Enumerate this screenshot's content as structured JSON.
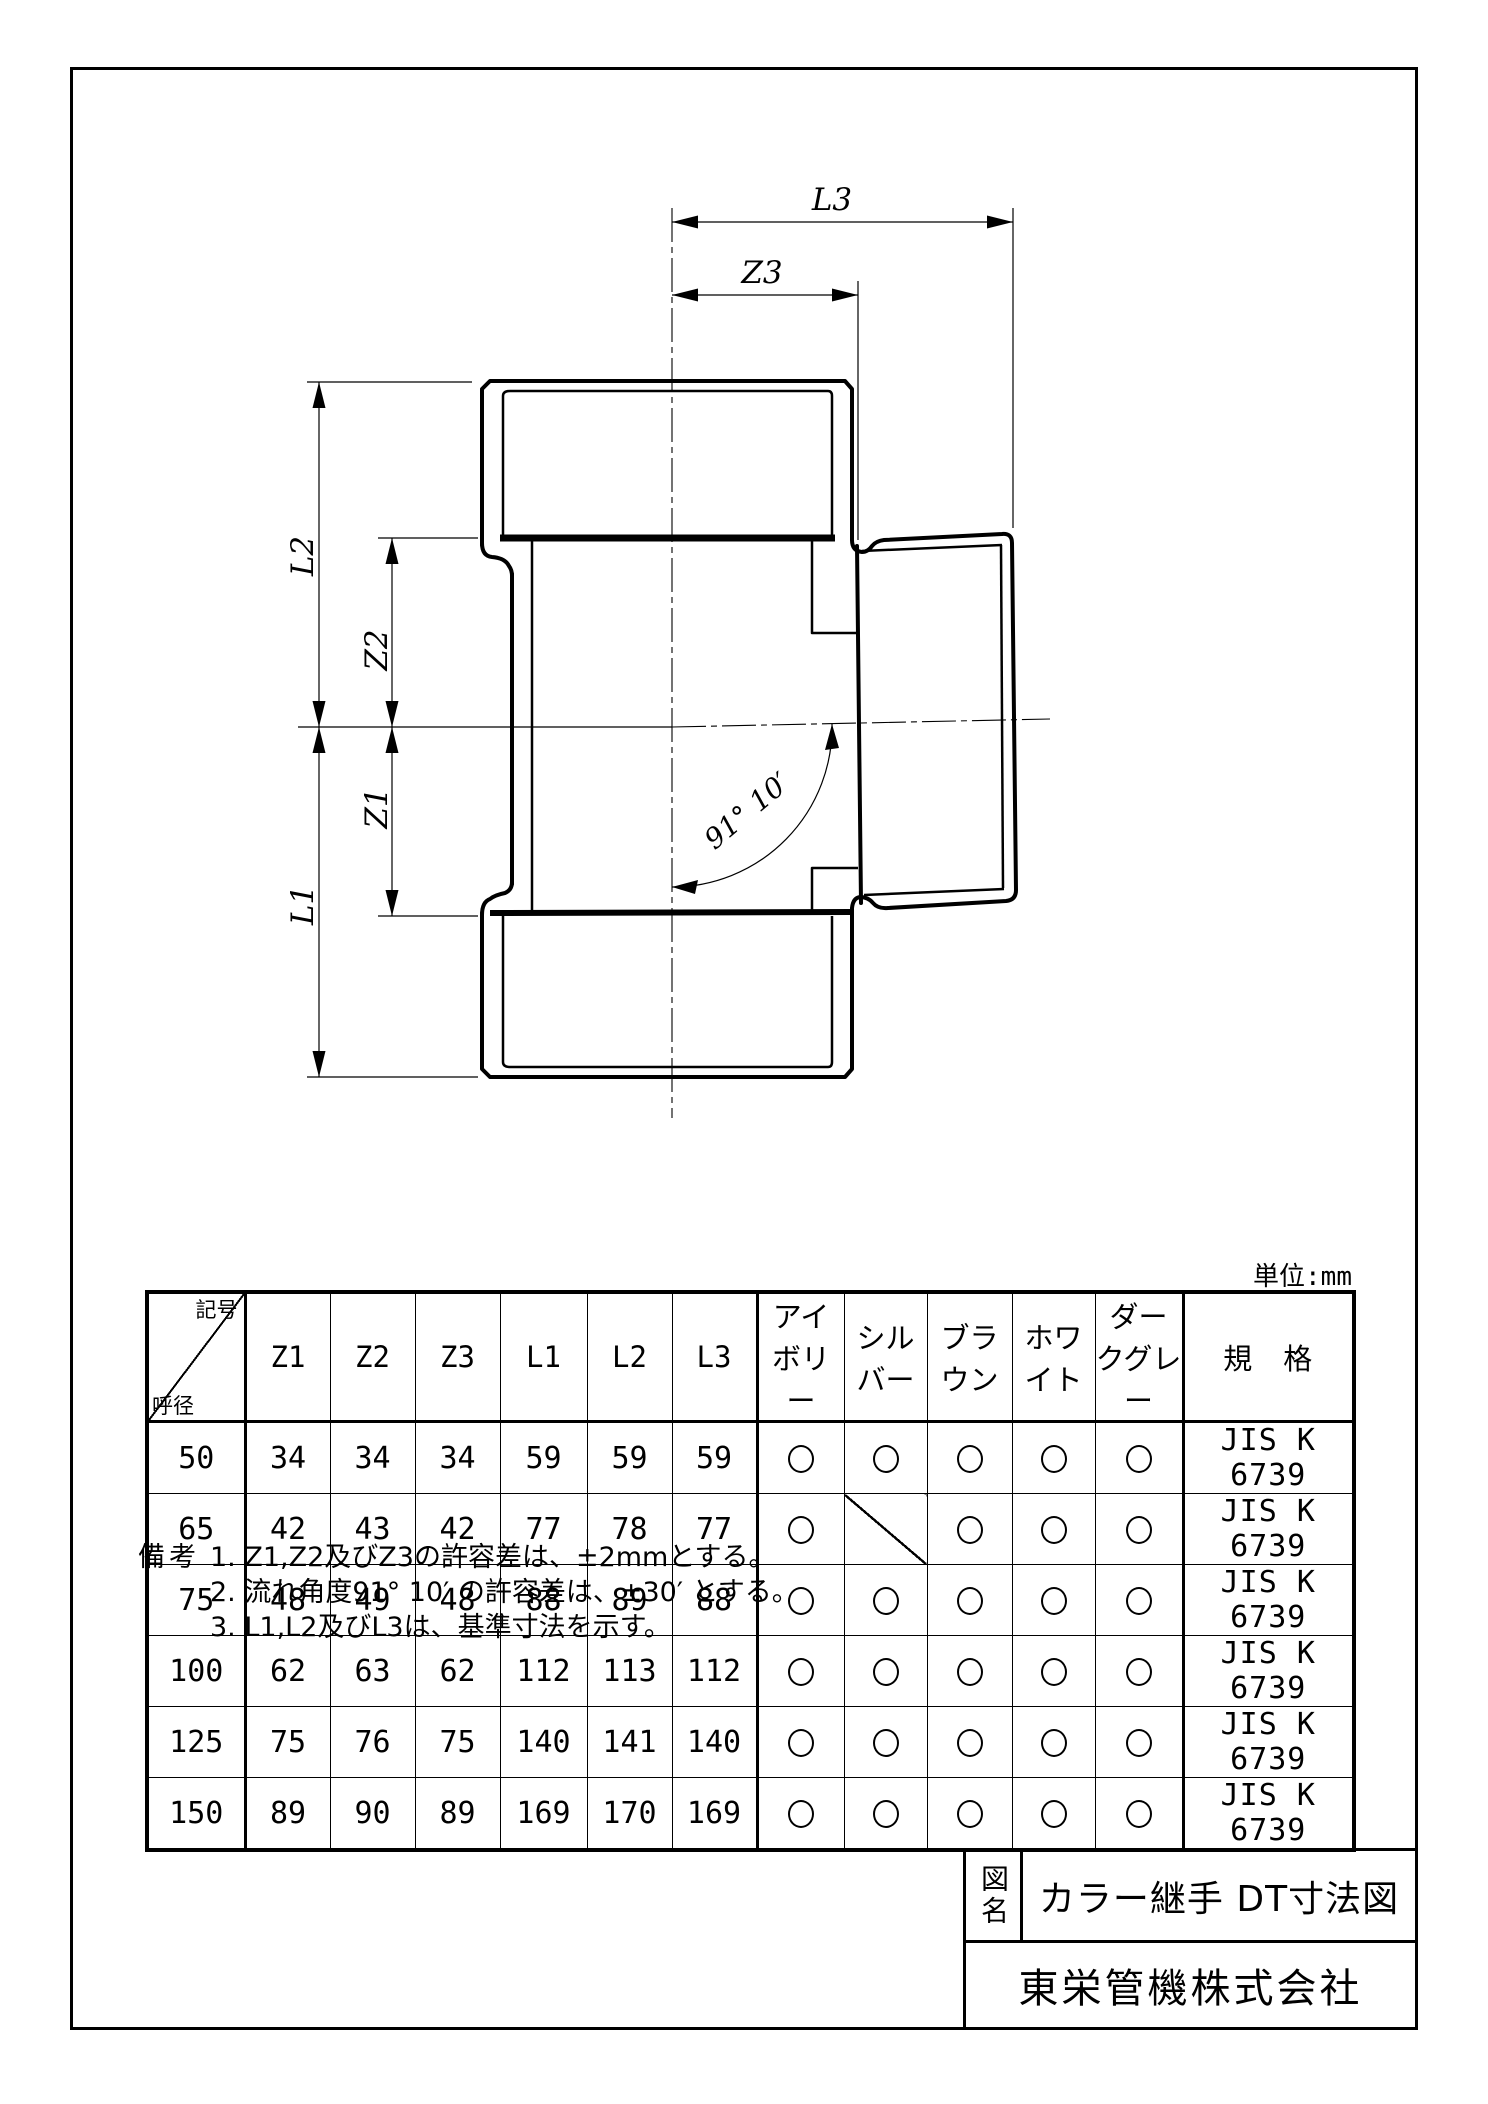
{
  "page": {
    "unit_label": "単位:mm"
  },
  "drawing": {
    "labels": {
      "l3": "L3",
      "z3": "Z3",
      "l2": "L2",
      "z2": "Z2",
      "z1": "Z1",
      "l1": "L1",
      "angle": "91° 10′"
    }
  },
  "table": {
    "corner": {
      "top_right": "記号",
      "bottom_left": "呼径"
    },
    "columns": [
      "Z1",
      "Z2",
      "Z3",
      "L1",
      "L2",
      "L3",
      "アイボリー",
      "シルバー",
      "ブラウン",
      "ホワイト",
      "ダークグレー",
      "規　格"
    ],
    "rows": [
      {
        "size": "50",
        "dims": [
          "34",
          "34",
          "34",
          "59",
          "59",
          "59"
        ],
        "colors": [
          "circle",
          "circle",
          "circle",
          "circle",
          "circle"
        ],
        "standard": "JIS K 6739"
      },
      {
        "size": "65",
        "dims": [
          "42",
          "43",
          "42",
          "77",
          "78",
          "77"
        ],
        "colors": [
          "circle",
          "slash",
          "circle",
          "circle",
          "circle"
        ],
        "standard": "JIS K 6739"
      },
      {
        "size": "75",
        "dims": [
          "48",
          "49",
          "48",
          "88",
          "89",
          "88"
        ],
        "colors": [
          "circle",
          "circle",
          "circle",
          "circle",
          "circle"
        ],
        "standard": "JIS K 6739"
      },
      {
        "size": "100",
        "dims": [
          "62",
          "63",
          "62",
          "112",
          "113",
          "112"
        ],
        "colors": [
          "circle",
          "circle",
          "circle",
          "circle",
          "circle"
        ],
        "standard": "JIS K 6739"
      },
      {
        "size": "125",
        "dims": [
          "75",
          "76",
          "75",
          "140",
          "141",
          "140"
        ],
        "colors": [
          "circle",
          "circle",
          "circle",
          "circle",
          "circle"
        ],
        "standard": "JIS K 6739"
      },
      {
        "size": "150",
        "dims": [
          "89",
          "90",
          "89",
          "169",
          "170",
          "169"
        ],
        "colors": [
          "circle",
          "circle",
          "circle",
          "circle",
          "circle"
        ],
        "standard": "JIS K 6739"
      }
    ]
  },
  "notes": {
    "heading": "備考",
    "items": [
      "1. Z1,Z2及びZ3の許容差は、±2mmとする。",
      "2. 流れ角度91° 10′ の許容差は、±30′ とする。",
      "3. L1,L2及びL3は、基準寸法を示す。"
    ]
  },
  "title_block": {
    "field_label": "図名",
    "drawing_title": "カラー継手 DT寸法図",
    "company": "東栄管機株式会社"
  }
}
